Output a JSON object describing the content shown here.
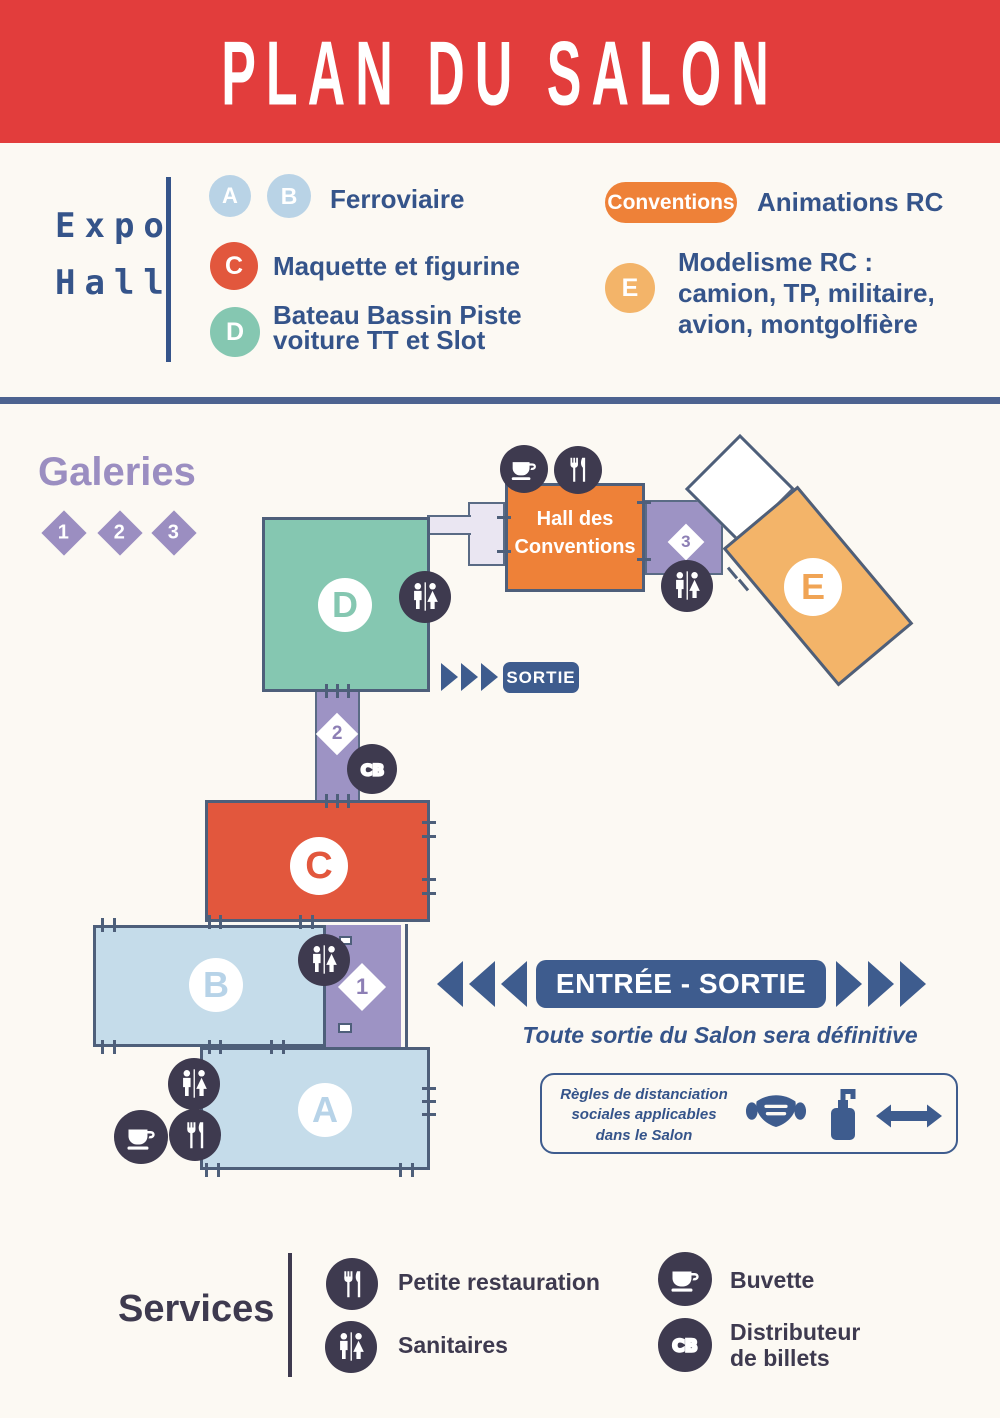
{
  "title": "PLAN DU SALON",
  "legend": {
    "group": {
      "line1": "Expo",
      "line2": "Hall"
    },
    "items": [
      {
        "badges": [
          "A",
          "B"
        ],
        "label": "Ferroviaire"
      },
      {
        "badges": [
          "C"
        ],
        "label": "Maquette et figurine"
      },
      {
        "badges": [
          "D"
        ],
        "lines": [
          "Bateau Bassin Piste",
          "voiture TT et Slot"
        ]
      }
    ],
    "conventions_badge": "Conventions",
    "conventions_label": "Animations RC",
    "e_badge": "E",
    "e_lines": [
      "Modelisme RC :",
      "camion, TP, militaire,",
      "avion, montgolfière"
    ]
  },
  "map": {
    "galleries_title": "Galeries",
    "gallery_numbers": [
      "1",
      "2",
      "3"
    ],
    "halls": {
      "a": "A",
      "b": "B",
      "c": "C",
      "d": "D",
      "e": "E"
    },
    "conventions_hall_lines": [
      "Hall des",
      "Conventions"
    ],
    "sortie_label": "SORTIE",
    "entree_sortie_label": "ENTRÉE - SORTIE",
    "exit_note": "Toute sortie du Salon sera définitive",
    "rules_lines": [
      "Règles de distanciation",
      "sociales applicables",
      "dans le Salon"
    ]
  },
  "services": {
    "title": "Services",
    "items": [
      {
        "icon": "cutlery-icon",
        "label": "Petite restauration"
      },
      {
        "icon": "toilets-icon",
        "label": "Sanitaires"
      },
      {
        "icon": "coffee-icon",
        "label": "Buvette"
      },
      {
        "icon": "atm-icon",
        "lines": [
          "Distributeur",
          "de billets"
        ]
      }
    ]
  },
  "icons": {
    "cb_label": "CB"
  },
  "colors": {
    "header_red": "#e23d3c",
    "navy_text": "#35548a",
    "icon_dark": "#3e3a4f",
    "teal": "#85c7b1",
    "light_blue": "#c5dcea",
    "orange": "#ee8138",
    "light_orange": "#f3b469",
    "red_orange": "#e2573d",
    "purple": "#9d93c4",
    "lavender": "#eae6f2",
    "slate_border": "#4e5f7a",
    "banner_blue": "#3e5c8e",
    "background": "#fcf9f3"
  }
}
